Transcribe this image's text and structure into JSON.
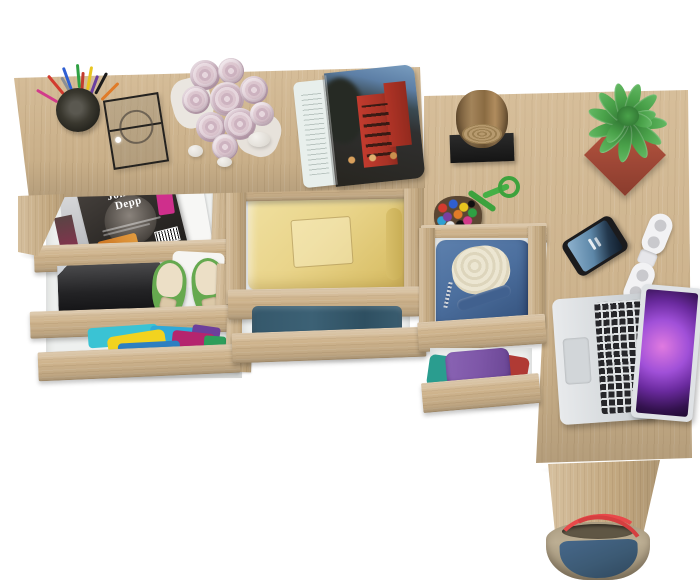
{
  "meta": {
    "kind": "3d product render, top-down view",
    "subject": "light oak desk with open storage drawers styled with props",
    "background_color": "#ffffff"
  },
  "palette": {
    "oak": "#d2b78f",
    "oak_dark": "#a98c63",
    "drawer_interior": "#eef0ef",
    "magazine_cover": "#34302d",
    "badge_pink": "#cf2f8c",
    "box_black": "#242426",
    "shoe_green": "#66a94f",
    "insole_beige": "#ecdfc6",
    "cloth_teal": "#3ac3d4",
    "cloth_yellow": "#f2d31f",
    "cloth_magenta": "#b5256e",
    "cloth_blue": "#2d7fc1",
    "shirt_yellow": "#e9d48a",
    "jeans_blue": "#3c6175",
    "denim_blue": "#4c6f9e",
    "fleece_cream": "#ece6d2",
    "towel_purple": "#7e57a8",
    "towel_teal": "#2a9d8f",
    "pot_red": "#b5533e",
    "plant_green": "#3f9140",
    "stump_brown": "#8a6b42",
    "stump_base": "#1f1f1f",
    "phone_screen": "#4a7ba6",
    "speaker_white": "#f2f2f4",
    "laptop_silver": "#d9dcdf",
    "laptop_wallpaper": "#8b3fc9",
    "bag_khaki": "#ac9d82",
    "bag_navy": "#3c5a74",
    "bag_strap_red": "#e8494a",
    "rose_pink": "#d5bfca"
  },
  "desk_left_items": {
    "pencil_cup": "mesh cup with colored pens",
    "display_case": "glass display box with black frame",
    "rose_bouquet": "pale pink roses",
    "pebbles": "three white stones",
    "open_magazine": "open magazine with red building photo"
  },
  "drawers": {
    "left_column": [
      {
        "name": "magazine-drawer",
        "contents": "celebrity magazine",
        "magazine_title": "Johnny Depp",
        "title_line1": "Johnny",
        "title_line2": "Depp"
      },
      {
        "name": "keepsake-drawer",
        "contents": "black storage box and green ballet flats"
      },
      {
        "name": "clothes-drawer",
        "contents": "colorful folded clothes"
      }
    ],
    "middle_column": [
      {
        "name": "shirt-drawer",
        "contents": "folded pale yellow shirt"
      },
      {
        "name": "jeans-drawer",
        "contents": "folded blue jeans"
      }
    ],
    "right_column": [
      {
        "name": "jacket-drawer",
        "contents": "denim jacket with cream fleece lining"
      },
      {
        "name": "towel-drawer",
        "contents": "purple and teal towels"
      }
    ]
  },
  "desk_right_items": {
    "stump_decor": "wooden log sculpture on black base",
    "bead_keychain": "multicolor bead charm with green cord",
    "potted_plant": "green plant in red square pot",
    "smartphone": "phone with blue lock screen",
    "folding_speaker": "white folding travel speakers",
    "laptop": "silver laptop with purple galaxy wallpaper"
  },
  "floor_items": {
    "tote_bag": "canvas tote bag, khaki and navy with red straps"
  }
}
